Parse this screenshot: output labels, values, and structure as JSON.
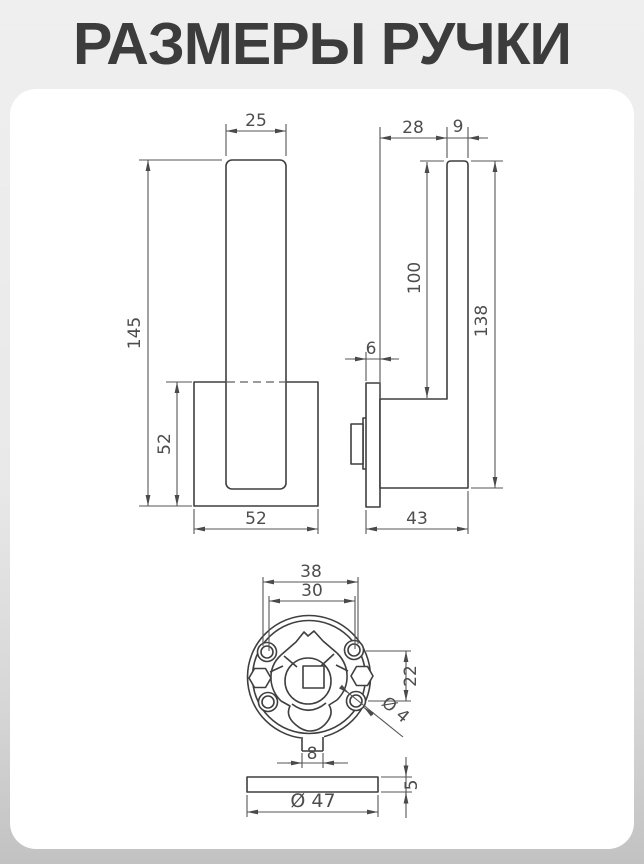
{
  "title": "РАЗМЕРЫ РУЧКИ",
  "colors": {
    "line": "#3f3f3f",
    "dim_line": "#565656",
    "dim_text": "#4d4d4d",
    "card": "#ffffff",
    "bg_top": "#efefef",
    "bg_bottom": "#c2c2c2",
    "title_text": "#3c3c3c"
  },
  "views": {
    "front": {
      "bar_width": "25",
      "total_height": "145",
      "plate_height": "52",
      "plate_width": "52"
    },
    "side": {
      "arm_offset": "28",
      "grip_thickness": "9",
      "grip_free_length": "100",
      "total_height": "138",
      "plate_thickness": "6",
      "total_depth": "43"
    },
    "rosette": {
      "mount_width": "38",
      "hole_span": "30",
      "hole_pitch": "22",
      "hole_diameter": "Ø 4",
      "tab_width": "8"
    },
    "disc": {
      "diameter": "Ø 47",
      "thickness": "5"
    }
  }
}
